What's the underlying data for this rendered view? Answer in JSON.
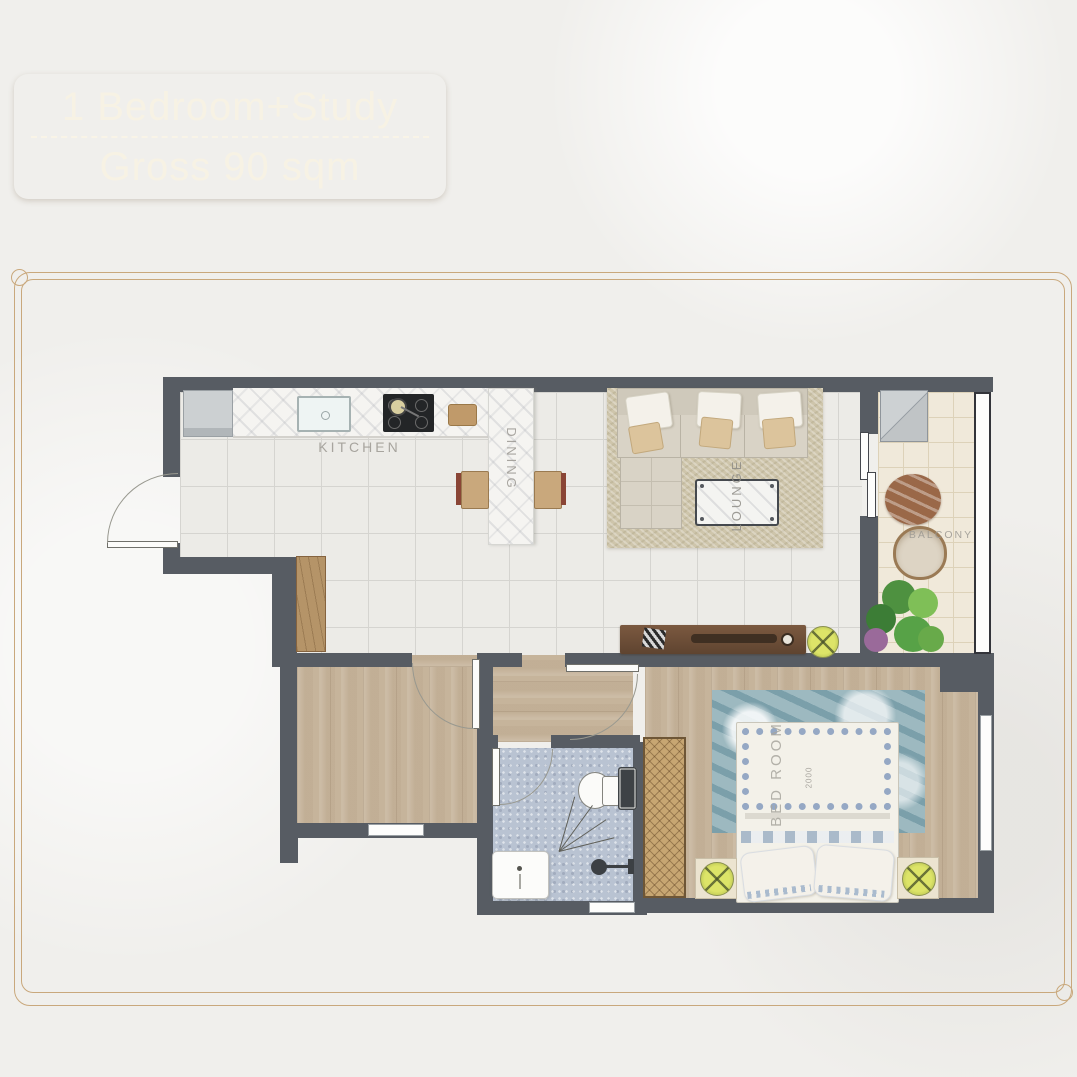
{
  "badge": {
    "title": "1 Bedroom+Study",
    "subtitle": "Gross 90 sqm"
  },
  "floorplan": {
    "labels": {
      "kitchen": "KITCHEN",
      "dining": "DINING",
      "lounge": "LOUNGE",
      "balcony": "BALCONY",
      "bedroom": "BED ROOM",
      "bed_width_mm": "2000"
    },
    "colors": {
      "wall": "#575c63",
      "tile": "#ecebe7",
      "tile_line": "#d5d4d0",
      "wood": "#c6b49b",
      "bath_tile": "#b9c3d2",
      "balcony_tile": "#f0e9da",
      "rug": "#cec5ab",
      "bed_rug": "#9db9c0",
      "accent_gold": "#b2977a",
      "frame_line": "#c9a87c",
      "label_text": "#9b9892",
      "lime": "#c9d25c",
      "rattan": "#c7a672",
      "walnut": "#6e4e38"
    }
  }
}
